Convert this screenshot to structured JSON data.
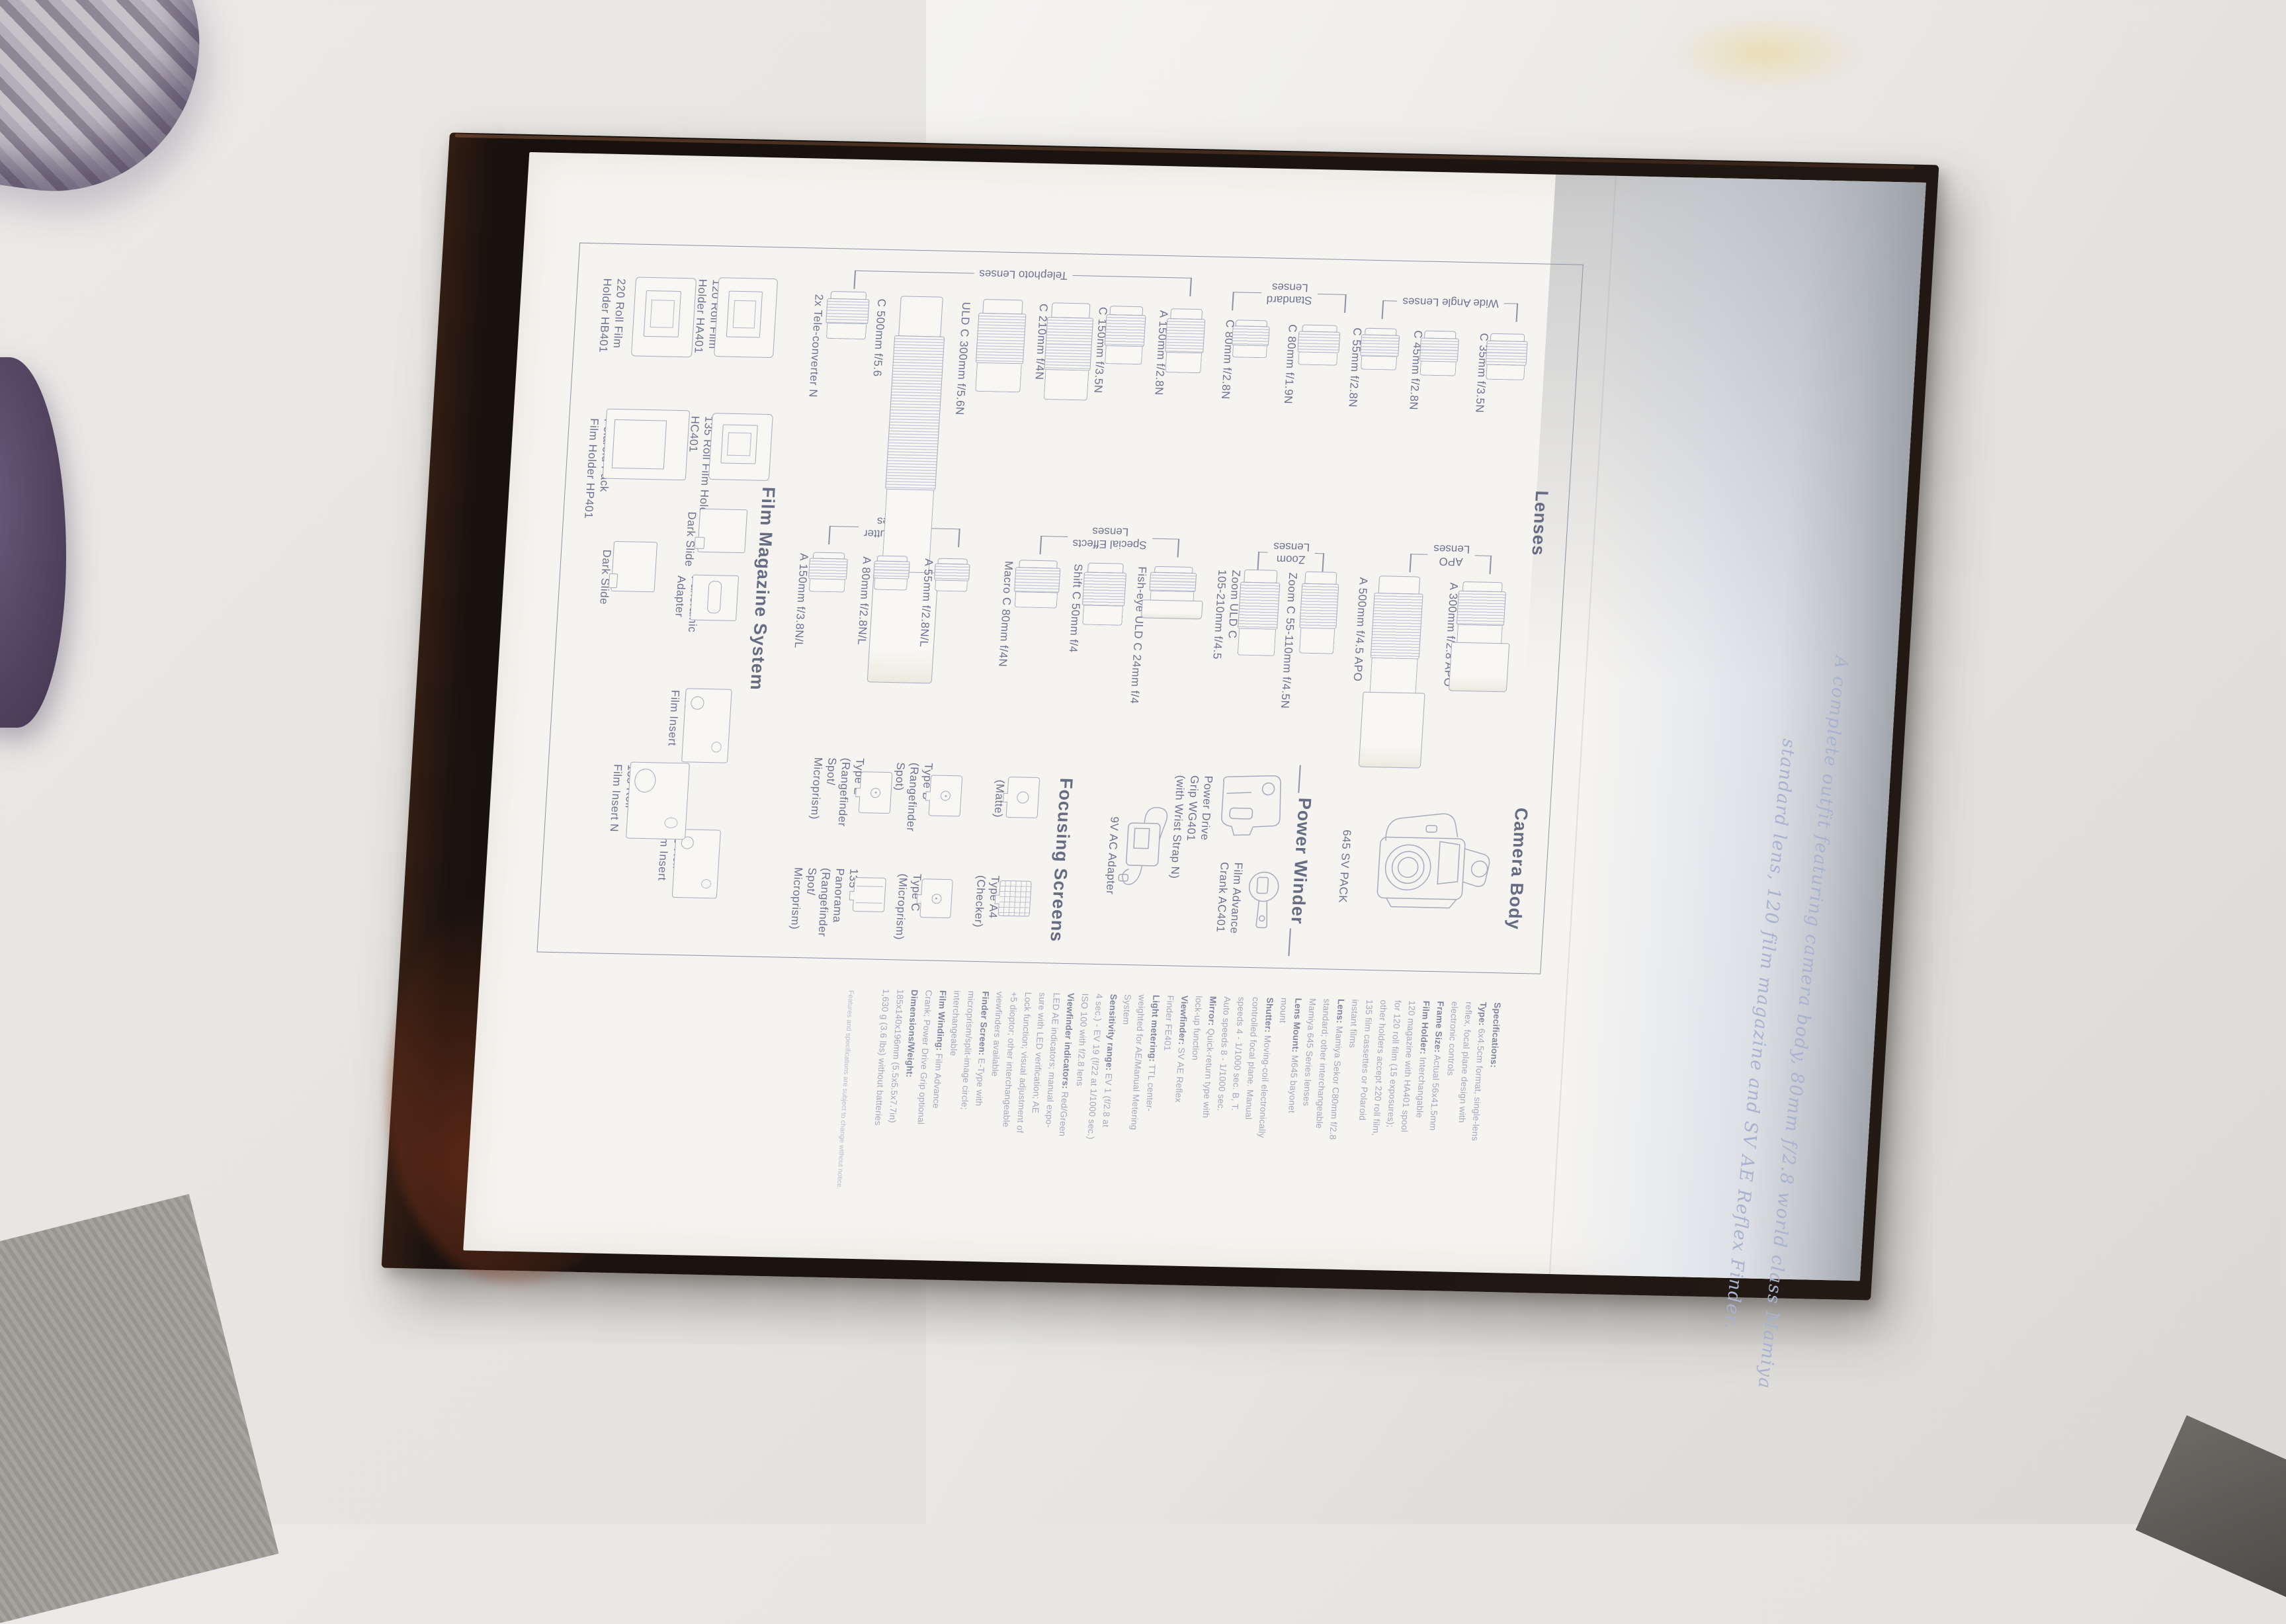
{
  "colors": {
    "print_ink": "#6d7390",
    "heading_ink": "#666c82",
    "tagline_ink": "#a9b2cf",
    "page": "#f6f4f0",
    "cover": "#1b1410"
  },
  "tagline": {
    "line1": "A complete outfit featuring camera body, 80mm f/2.8 world class Mamiya",
    "line2": "standard lens, 120 film magazine and SV AE Reflex Finder."
  },
  "headings": {
    "lenses": "Lenses",
    "camera_body": "Camera Body",
    "power_winder": "Power Winder",
    "focusing_screens": "Focusing Screens",
    "film_magazine": "Film Magazine System"
  },
  "lens_groups": [
    {
      "lines": [
        "Telephoto Lenses"
      ]
    },
    {
      "lines": [
        "Standard",
        "Lenses"
      ]
    },
    {
      "lines": [
        "Wide Angle Lenses"
      ]
    },
    {
      "lines": [
        "Leaf Shutter",
        "Lenses"
      ]
    },
    {
      "lines": [
        "Special Effects",
        "Lenses"
      ]
    },
    {
      "lines": [
        "Zoom",
        "Lenses"
      ]
    },
    {
      "lines": [
        "APO",
        "Lenses"
      ]
    }
  ],
  "top_row_lenses": [
    {
      "lines": [
        "2x Tele-converter N"
      ]
    },
    {
      "lines": [
        "C 500mm f/5.6"
      ]
    },
    {
      "lines": [
        "ULD C 300mm f/5.6N"
      ]
    },
    {
      "lines": [
        "C 210mm f/4N"
      ]
    },
    {
      "lines": [
        "C 150mm f/3.5N"
      ]
    },
    {
      "lines": [
        "A 150mm f/2.8N"
      ]
    },
    {
      "lines": [
        "C 80mm f/2.8N"
      ]
    },
    {
      "lines": [
        "C 80mm f/1.9N"
      ]
    },
    {
      "lines": [
        "C 55mm f/2.8N"
      ]
    },
    {
      "lines": [
        "C 45mm f/2.8N"
      ]
    },
    {
      "lines": [
        "C 35mm f/3.5N"
      ]
    }
  ],
  "mid_row_lenses": [
    {
      "lines": [
        "A 150mm f/3.8N/L"
      ]
    },
    {
      "lines": [
        "A 80mm f/2.8N/L"
      ]
    },
    {
      "lines": [
        "A 55mm f/2.8N/L"
      ]
    },
    {
      "lines": [
        "Macro C 80mm f/4N"
      ]
    },
    {
      "lines": [
        "Shift C 50mm f/4"
      ]
    },
    {
      "lines": [
        "Fish-eye ULD C 24mm f/4"
      ]
    },
    {
      "lines": [
        "Zoom ULD C",
        "105-210mm f/4.5"
      ]
    },
    {
      "lines": [
        "Zoom C 55-110mm f/4.5N"
      ]
    },
    {
      "lines": [
        "A 500mm f/4.5 APO"
      ]
    },
    {
      "lines": [
        "A 300mm f/2.8 APO"
      ]
    }
  ],
  "camera": {
    "pack_label": "645 SV PACK"
  },
  "winder_items": [
    {
      "lines": [
        "Power Drive",
        "Grip WG401",
        "(with Wrist Strap N)"
      ]
    },
    {
      "lines": [
        "Film Advance",
        "Crank AC401"
      ]
    },
    {
      "lines": [
        "9V AC Adapter"
      ]
    }
  ],
  "screen_items": [
    {
      "lines": [
        "Type A",
        "(Matte)"
      ]
    },
    {
      "lines": [
        "Type A4",
        "(Checker)"
      ]
    },
    {
      "lines": [
        "Type B",
        "(Rangefinder",
        "Spot)"
      ]
    },
    {
      "lines": [
        "Type C",
        "(Microprism)"
      ]
    },
    {
      "lines": [
        "Type E",
        "(Rangefinder",
        "Spot/",
        "Microprism)"
      ]
    },
    {
      "lines": [
        "135",
        "Panorama",
        "(Rangefinder",
        "Spot/",
        "Microprism)"
      ]
    }
  ],
  "magazine_items": [
    {
      "lines": [
        "220 Roll Film",
        "Holder HB401"
      ]
    },
    {
      "lines": [
        "120 Roll Film",
        "Holder HA401"
      ]
    },
    {
      "lines": [
        "Polaroid Pack",
        "Film Holder HP401"
      ]
    },
    {
      "lines": [
        "135 Roll Film Holder",
        "HC401"
      ]
    },
    {
      "lines": [
        "Dark Slide"
      ]
    },
    {
      "lines": [
        "Dark Slide"
      ]
    },
    {
      "lines": [
        "Panoramic",
        "Adapter"
      ]
    },
    {
      "lines": [
        "120 Roll",
        "Film Insert"
      ]
    },
    {
      "lines": [
        "220 Roll",
        "Film Insert"
      ]
    },
    {
      "lines": [
        "135 Roll",
        "Film Insert N"
      ]
    }
  ],
  "specs": {
    "lines": [
      {
        "b": "Specifications:",
        "t": ""
      },
      {
        "b": "Type:",
        "t": " 6x4.5cm format, single-lens"
      },
      {
        "t": "reflex, focal plane design with"
      },
      {
        "t": "electronic controls"
      },
      {
        "b": "Frame Size:",
        "t": " Actual 56x41.5mm"
      },
      {
        "b": "Film Holder:",
        "t": " Interchangable"
      },
      {
        "t": "120 magazine with HA401 spool"
      },
      {
        "t": "for 120 roll film (15 exposures);"
      },
      {
        "t": "other holders accept 220 roll film,"
      },
      {
        "t": "135 film cassettes or Polaroid"
      },
      {
        "t": "instant films"
      },
      {
        "b": "Lens:",
        "t": " Mamiya Sekor C80mm f/2.8"
      },
      {
        "t": "standard; other interchangeable"
      },
      {
        "t": "Mamiya 645 Series lenses"
      },
      {
        "b": "Lens Mount:",
        "t": " M645 bayonet"
      },
      {
        "t": "mount"
      },
      {
        "b": "Shutter:",
        "t": " Moving-coil electronically"
      },
      {
        "t": "controlled focal plane. Manual"
      },
      {
        "t": "speeds 4 - 1/1000 sec. B, T."
      },
      {
        "t": "Auto speeds 8 - 1/1000 sec."
      },
      {
        "b": "Mirror:",
        "t": " Quick-return type with"
      },
      {
        "t": "lock-up function"
      },
      {
        "b": "Viewfinder:",
        "t": " SV AE Reflex"
      },
      {
        "t": "Finder FE401"
      },
      {
        "b": "Light metering:",
        "t": " TTL center-"
      },
      {
        "t": "weighted for AE/Manual Metering"
      },
      {
        "t": "System"
      },
      {
        "b": "Sensitivity range:",
        "t": " EV 1 (f/2.8 at"
      },
      {
        "t": "4 sec.) - EV 19 (f/22 at 1/1000 sec.)"
      },
      {
        "t": "ISO 100 with f/2.8 lens"
      },
      {
        "b": "Viewfinder indicators:",
        "t": " Red/Green"
      },
      {
        "t": "LED AE indicators; manual expo-"
      },
      {
        "t": "sure with LED verification; AE"
      },
      {
        "t": "Lock function; visual adjustment of"
      },
      {
        "t": "+5 dioptor; other interchangeable"
      },
      {
        "t": "viewfinders available"
      },
      {
        "b": "Finder Screen:",
        "t": " E-Type with"
      },
      {
        "t": "microprism/split-image circle;"
      },
      {
        "t": "interchangeable"
      },
      {
        "b": "Film Winding:",
        "t": " Film Advance"
      },
      {
        "t": "Crank; Power Drive Grip optional"
      },
      {
        "b": "Dimensions/Weight:",
        "t": ""
      },
      {
        "t": "185x140x196mm (5.5x5.5x7.7in)"
      },
      {
        "t": "1,630 g (3.6 lbs) without batteries"
      }
    ],
    "footnote": "Features and specifications are subject to change without notice."
  }
}
